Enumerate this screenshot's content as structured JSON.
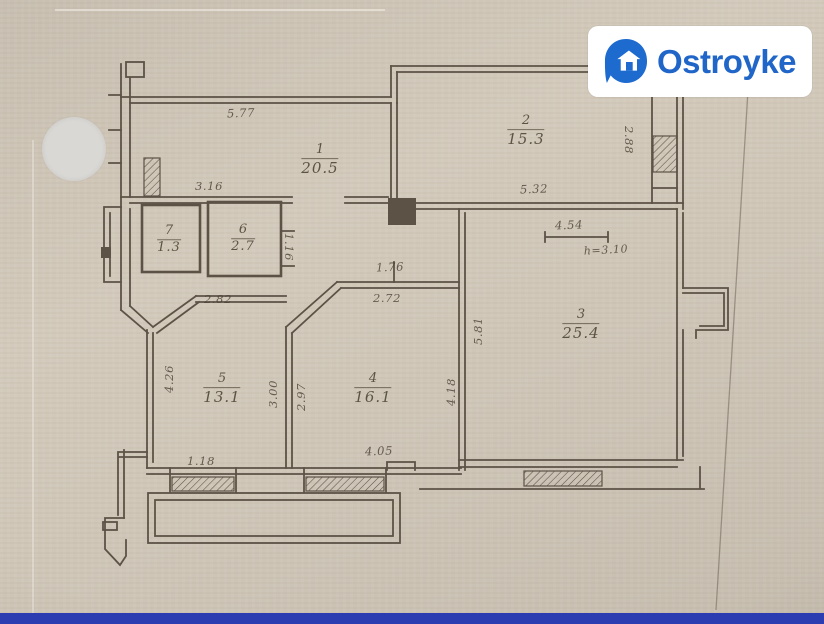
{
  "logo": {
    "name": "Ostroyke"
  },
  "plan": {
    "rooms": [
      {
        "number": "1",
        "area": "20.5"
      },
      {
        "number": "2",
        "area": "15.3"
      },
      {
        "number": "3",
        "area": "25.4"
      },
      {
        "number": "4",
        "area": "16.1"
      },
      {
        "number": "5",
        "area": "13.1"
      },
      {
        "number": "6",
        "area": "2.7"
      },
      {
        "number": "7",
        "area": "1.3"
      }
    ],
    "dims": {
      "room1_width": "5.77",
      "hall_width": "3.16",
      "room2_width": "5.32",
      "room2_depth": "2.88",
      "room3_width": "4.54",
      "ceiling_height": "h=3.10",
      "hall_seg_upper": "1.76",
      "hall_seg_lower": "2.72",
      "room3_left_depth": "5.81",
      "room4_right_depth": "4.18",
      "room5_top_width": "2.82",
      "room5_right_depth": "3.00",
      "room4_left_depth": "2.97",
      "room5_left_depth": "4.26",
      "room5_window": "1.18",
      "room4_width": "4.05",
      "room6_door": "1.16"
    }
  },
  "colors": {
    "accent_blue": "#2065c8",
    "footer_bar": "#2b3db0",
    "paper": "#cfc6b8",
    "ink": "#50463a"
  }
}
